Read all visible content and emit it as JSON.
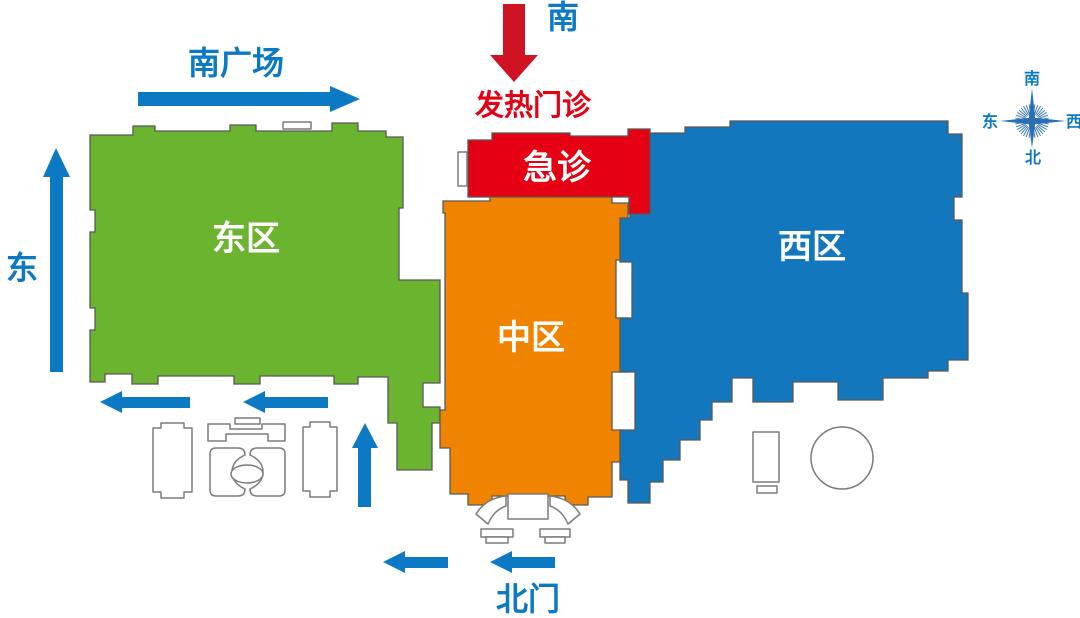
{
  "labels": {
    "south": "南",
    "fever_clinic": "发热门诊",
    "emergency": "急诊",
    "east_zone": "东区",
    "middle_zone": "中区",
    "west_zone": "西区",
    "south_plaza": "南广场",
    "east": "东",
    "north_gate": "北门"
  },
  "compass": {
    "top": "南",
    "bottom": "北",
    "left": "东",
    "right": "西"
  },
  "colors": {
    "east_zone": "#6ab42f",
    "middle_zone": "#f08300",
    "west_zone": "#1377bd",
    "emergency_zone": "#e60013",
    "fever_text": "#e60013",
    "zone_label_text": "#ffffff",
    "direction_text": "#0b79c3",
    "arrow_blue": "#0b79c3",
    "arrow_red": "#cf1322",
    "compass_blue": "#2a6fb5",
    "zone_outline": "#595757",
    "building_outline": "#7b7b7b"
  }
}
